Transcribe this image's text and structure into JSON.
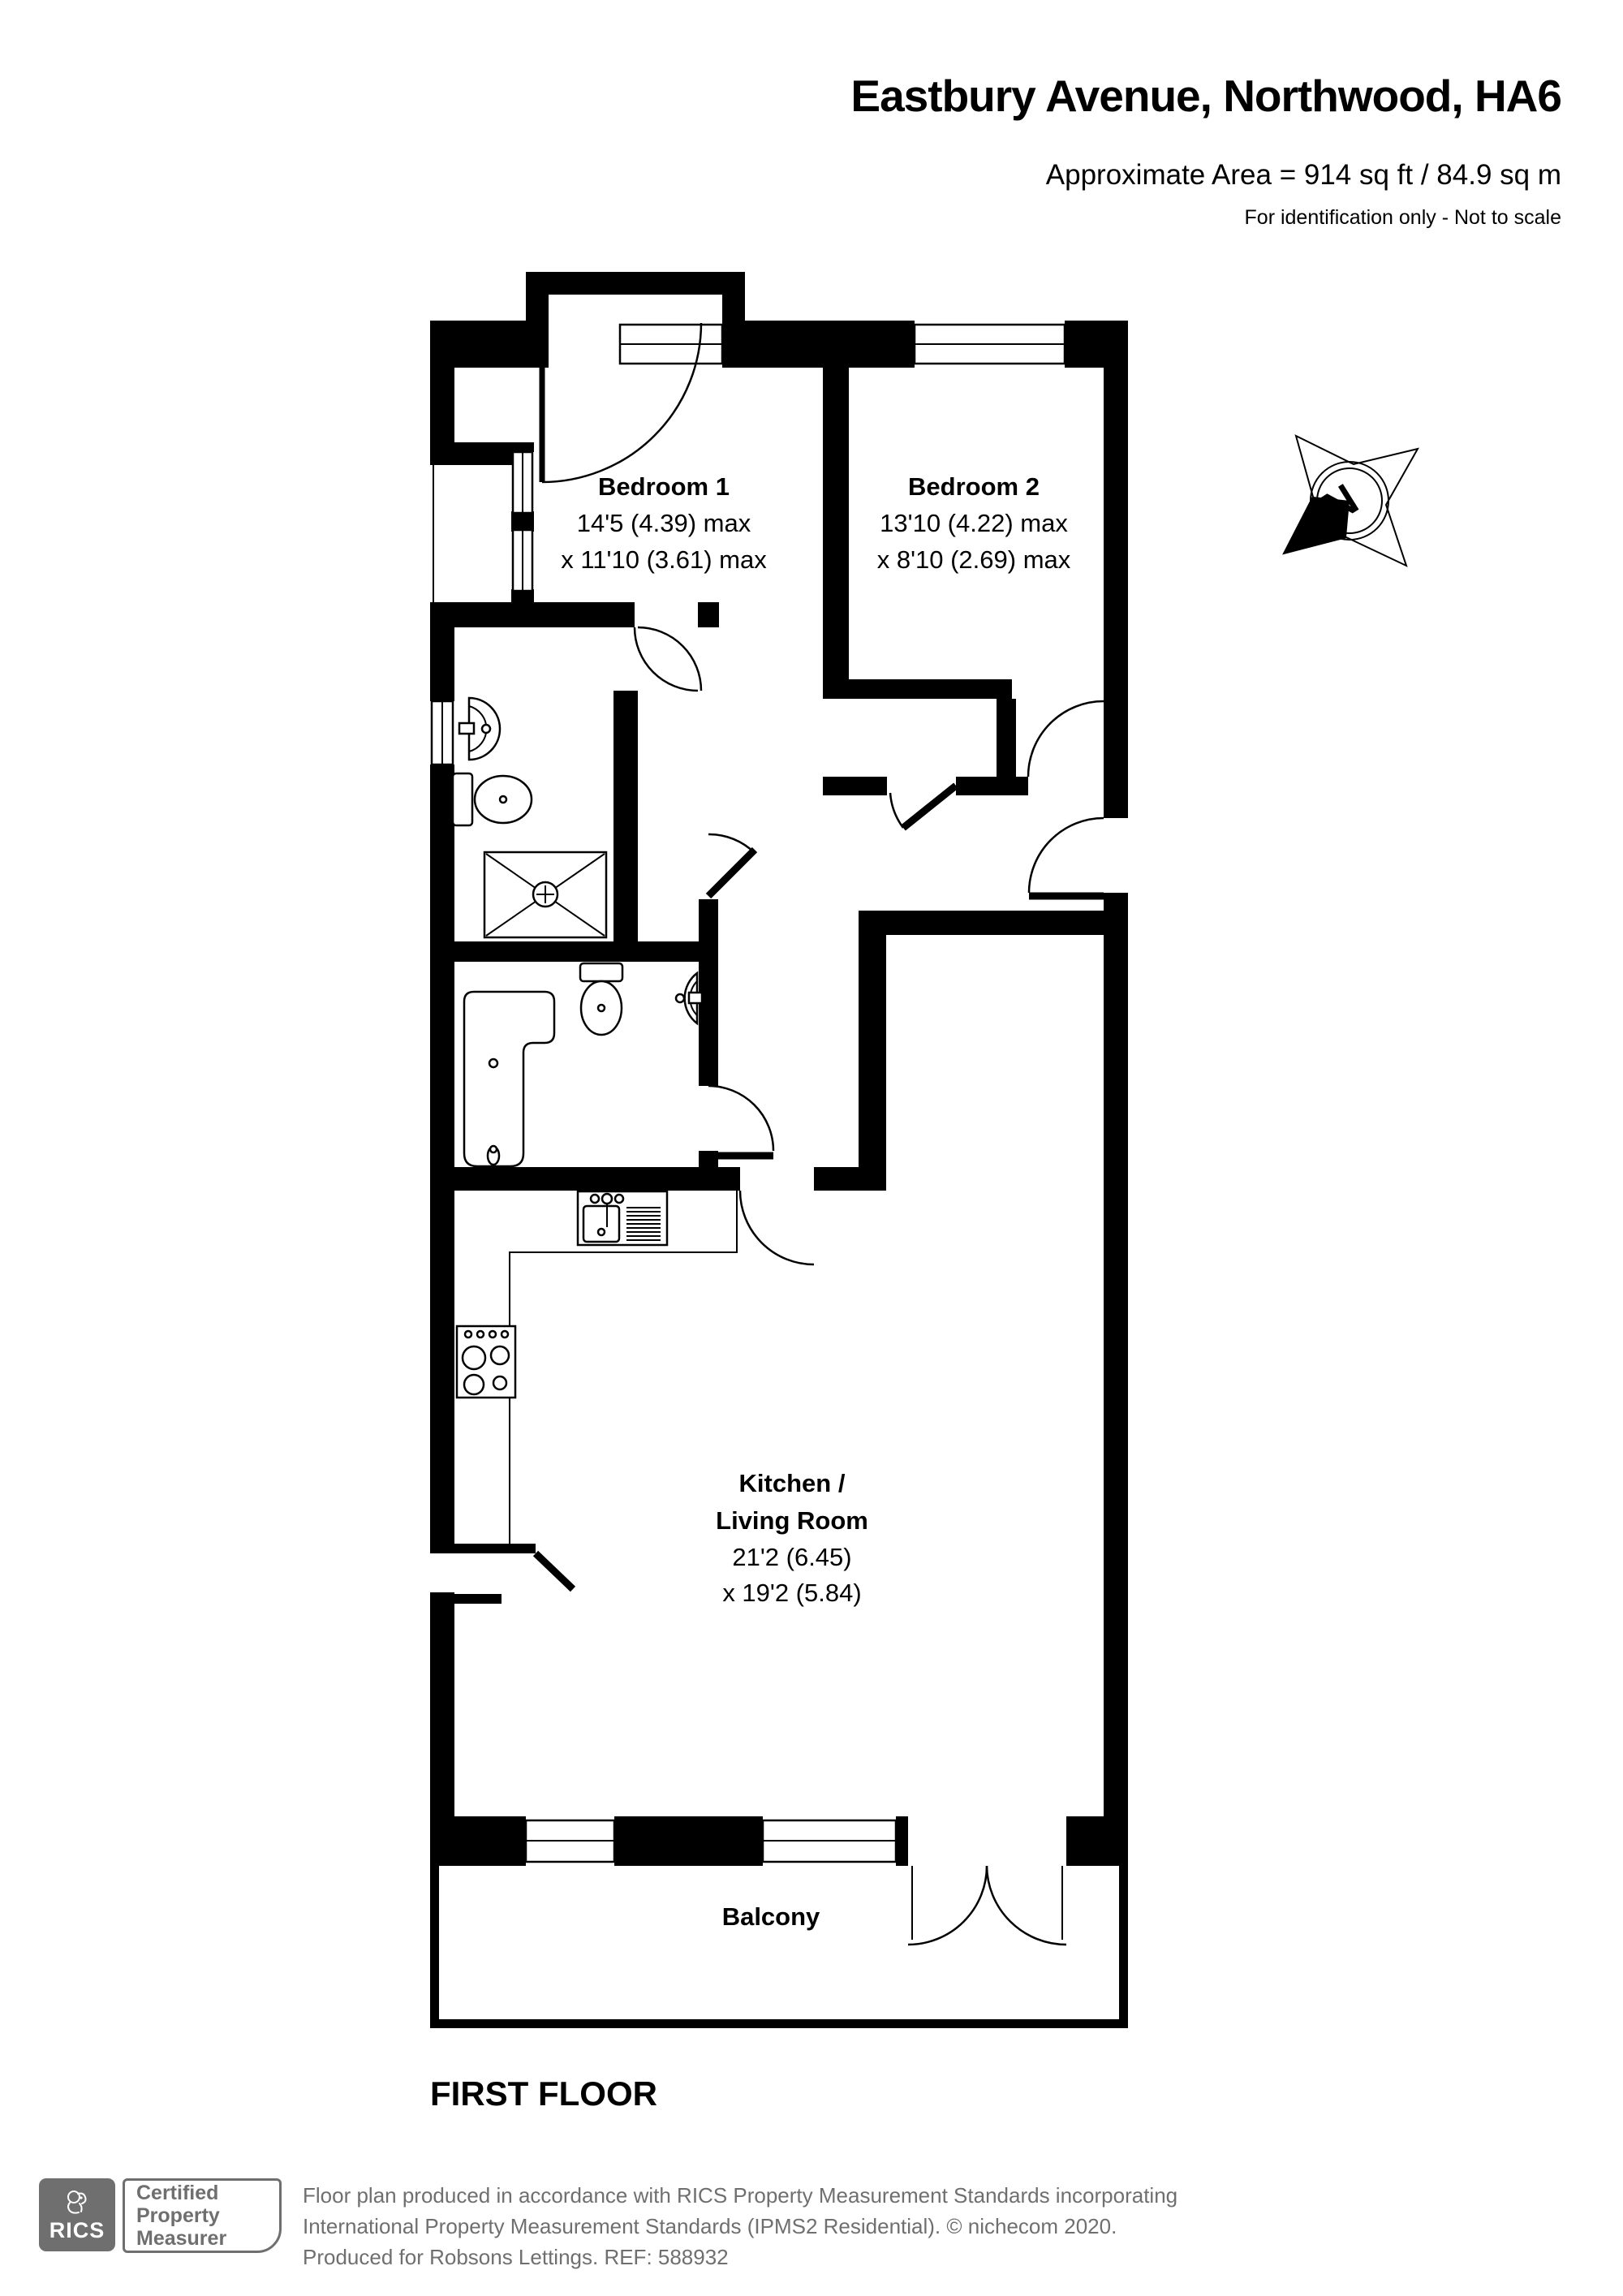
{
  "header": {
    "title": "Eastbury Avenue, Northwood, HA6",
    "area": "Approximate Area = 914 sq ft / 84.9 sq m",
    "note": "For identification only - Not to scale"
  },
  "rooms": {
    "bedroom1": {
      "name": "Bedroom 1",
      "dim1": "14'5 (4.39) max",
      "dim2": "x 11'10 (3.61) max"
    },
    "bedroom2": {
      "name": "Bedroom 2",
      "dim1": "13'10 (4.22) max",
      "dim2": "x 8'10 (2.69) max"
    },
    "kitchen": {
      "name_line1": "Kitchen /",
      "name_line2": "Living Room",
      "dim1": "21'2 (6.45)",
      "dim2": "x 19'2 (5.84)"
    },
    "balcony": {
      "name": "Balcony"
    }
  },
  "floor_label": "FIRST FLOOR",
  "compass": {
    "north_letter": "N"
  },
  "footer": {
    "rics_logo_text": "RICS",
    "badge_lines": [
      "Certified",
      "Property",
      "Measurer"
    ],
    "line1": "Floor plan produced in accordance with RICS Property Measurement Standards incorporating",
    "line2": "International Property Measurement Standards (IPMS2 Residential).   © nichecom 2020.",
    "line3": "Produced for Robsons Lettings.   REF: 588932"
  },
  "colors": {
    "wall": "#000000",
    "background": "#ffffff",
    "footer_gray": "#6f6f6f"
  }
}
